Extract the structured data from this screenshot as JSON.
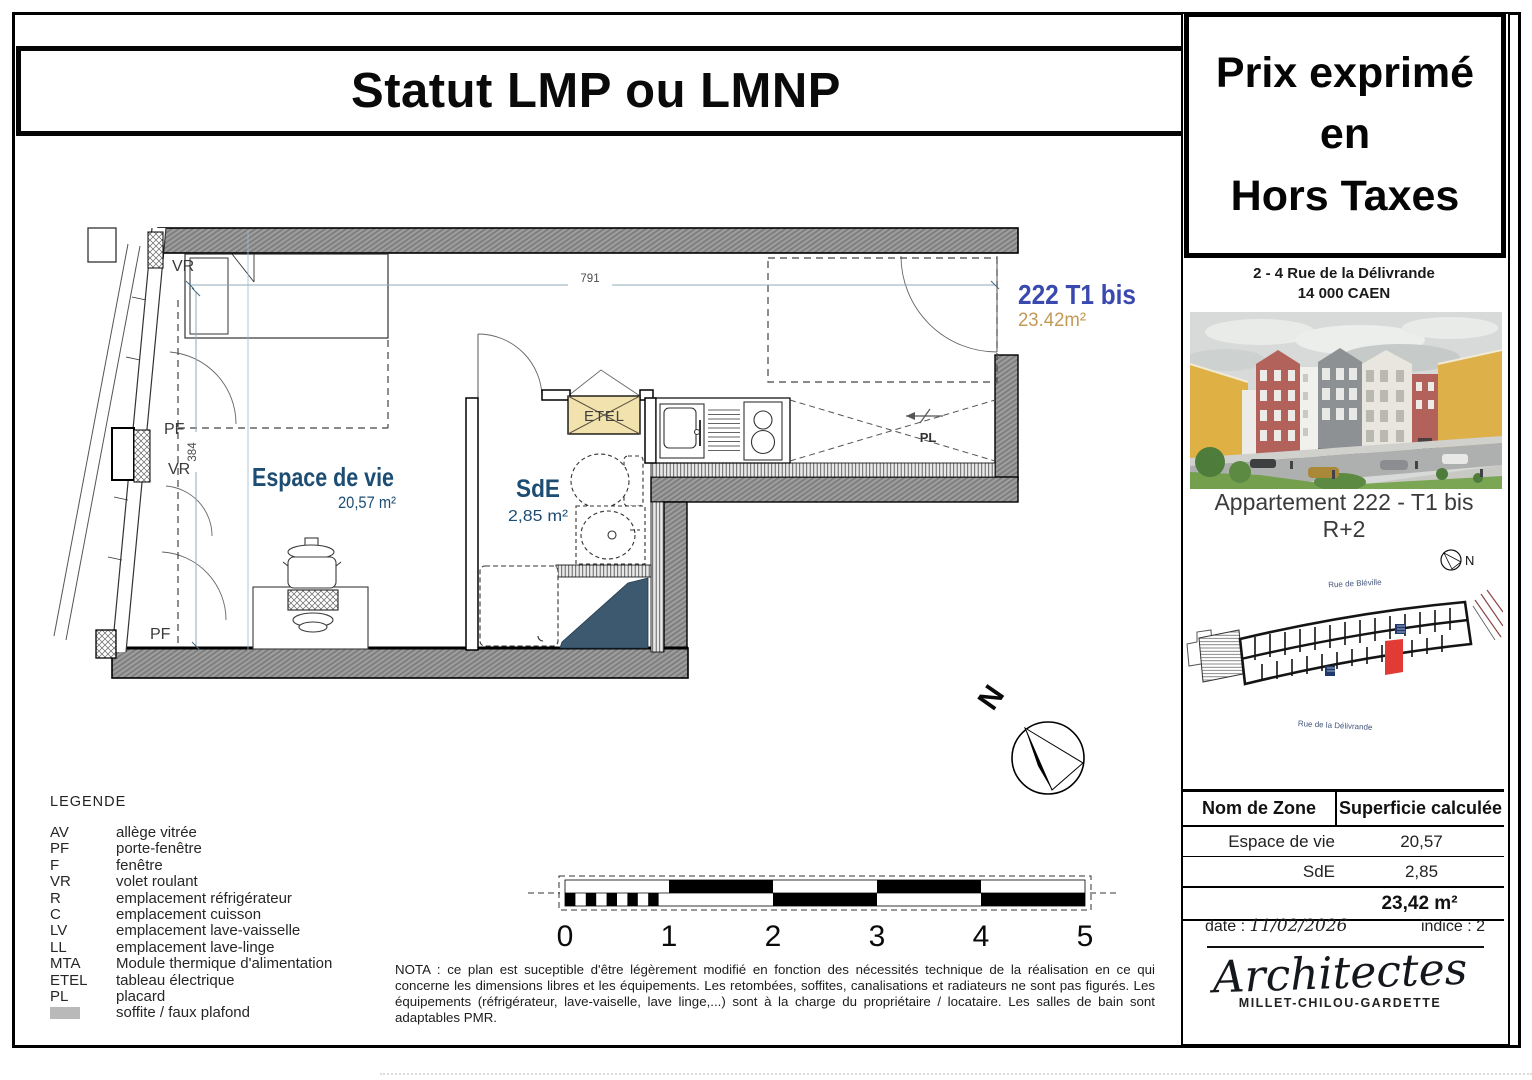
{
  "page": {
    "title": "Statut LMP ou LMNP"
  },
  "price_box": {
    "line1": "Prix exprimé",
    "line2": "en",
    "line3": "Hors Taxes"
  },
  "project": {
    "address_line1": "2 - 4 Rue de la Délivrande",
    "address_line2": "14 000 CAEN",
    "apartment_line1": "Appartement 222 - T1 bis",
    "apartment_line2": "R+2"
  },
  "site_plan": {
    "street_top": "Rue de Bléville",
    "street_bottom": "Rue de la Délivrande",
    "north_label": "N",
    "highlight_color": "#e23b36"
  },
  "plan": {
    "unit_number": "222 T1 bis",
    "unit_area": "23.42m²",
    "rooms": [
      {
        "name": "Espace de vie",
        "area": "20,57 m²"
      },
      {
        "name": "SdE",
        "area": "2,85 m²"
      }
    ],
    "labels": {
      "etel": "ETEL",
      "pl": "PL"
    },
    "wall_labels": [
      "VR",
      "PF",
      "VR",
      "PF"
    ],
    "dimensions": {
      "width": "791",
      "height": "384"
    },
    "north_label": "N",
    "colors": {
      "room_label": "#1d4d73",
      "unit_number": "#3a49ae",
      "unit_area": "#c29a55",
      "etel_fill": "#f2e3ae",
      "soffit_wedge": "#3d5970"
    }
  },
  "legend": {
    "title": "LEGENDE",
    "items": [
      {
        "abbr": "AV",
        "label": "allège vitrée"
      },
      {
        "abbr": "PF",
        "label": "porte-fenêtre"
      },
      {
        "abbr": "F",
        "label": "fenêtre"
      },
      {
        "abbr": "VR",
        "label": "volet roulant"
      },
      {
        "abbr": "R",
        "label": "emplacement réfrigérateur"
      },
      {
        "abbr": "C",
        "label": "emplacement cuisson"
      },
      {
        "abbr": "LV",
        "label": "emplacement lave-vaisselle"
      },
      {
        "abbr": "LL",
        "label": "emplacement lave-linge"
      },
      {
        "abbr": "MTA",
        "label": "Module thermique d'alimentation"
      },
      {
        "abbr": "ETEL",
        "label": "tableau électrique"
      },
      {
        "abbr": "PL",
        "label": "placard"
      },
      {
        "abbr": "",
        "label": "soffite / faux plafond",
        "swatch_color": "#b9b9b9"
      }
    ]
  },
  "scale_bar": {
    "ticks": [
      "0",
      "1",
      "2",
      "3",
      "4",
      "5"
    ]
  },
  "nota": "NOTA : ce plan est suceptible d'être légèrement modifié en fonction des nécessités technique de la réalisation en ce qui concerne les dimensions libres et les équipements. Les retombées, soffites, canalisations et radiateurs ne sont pas figurés. Les équipements (réfrigérateur, lave-vaiselle, lave linge,...) sont à la charge du propriétaire / locataire. Les salles de bain sont adaptables PMR.",
  "area_table": {
    "headers": [
      "Nom de Zone",
      "Superficie calculée"
    ],
    "rows": [
      [
        "Espace de vie",
        "20,57"
      ],
      [
        "SdE",
        "2,85"
      ]
    ],
    "total": "23,42 m²"
  },
  "footer": {
    "date_label": "date :",
    "date_value": "11/02/2026",
    "indice": "indice : 2",
    "architect_name": "Architectes",
    "architect_sub": "MILLET-CHILOU-GARDETTE"
  }
}
